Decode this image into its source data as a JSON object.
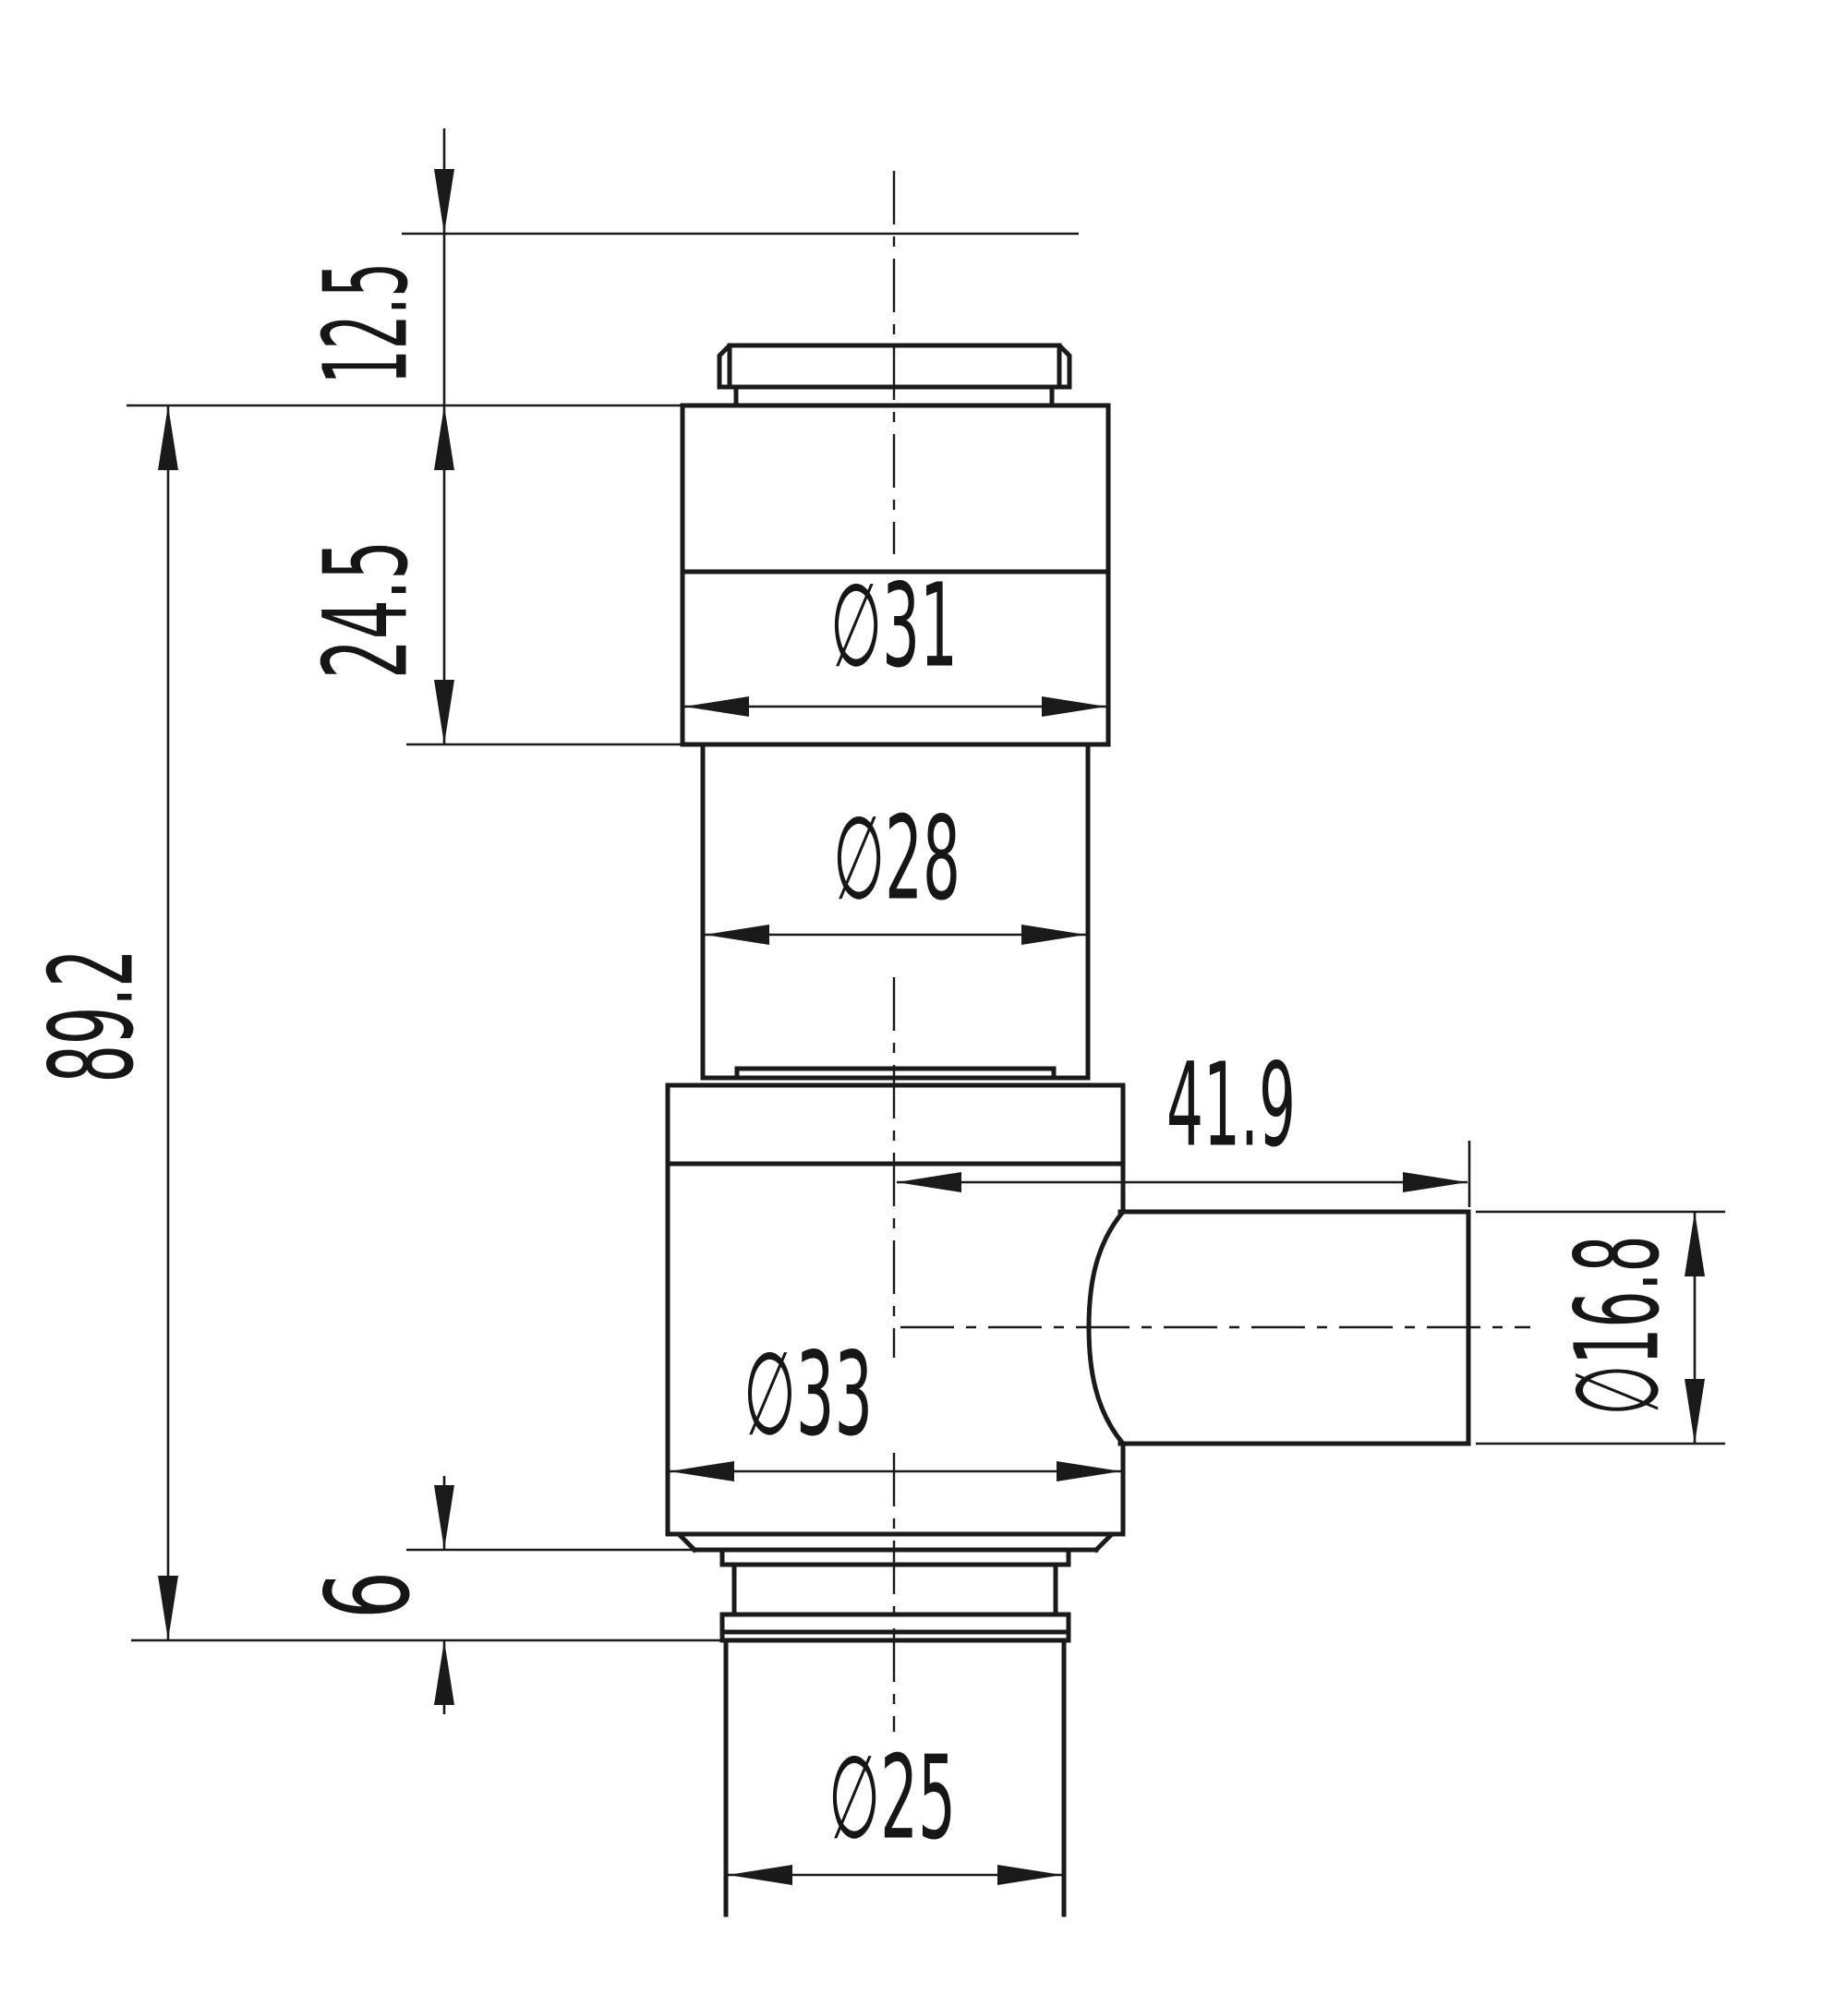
{
  "drawing": {
    "background_color": "#ffffff",
    "line_color": "#1a1a1a",
    "labels": {
      "seg_top_height": "12.5",
      "seg_upper_height": "24.5",
      "overall_height": "89.2",
      "groove_height": "6",
      "dia_top_section": "∅31",
      "dia_mid_section": "∅28",
      "dia_main_body": "∅33",
      "dia_bottom_tube": "∅25",
      "port_length": "41.9",
      "dia_port": "∅16.8"
    }
  }
}
